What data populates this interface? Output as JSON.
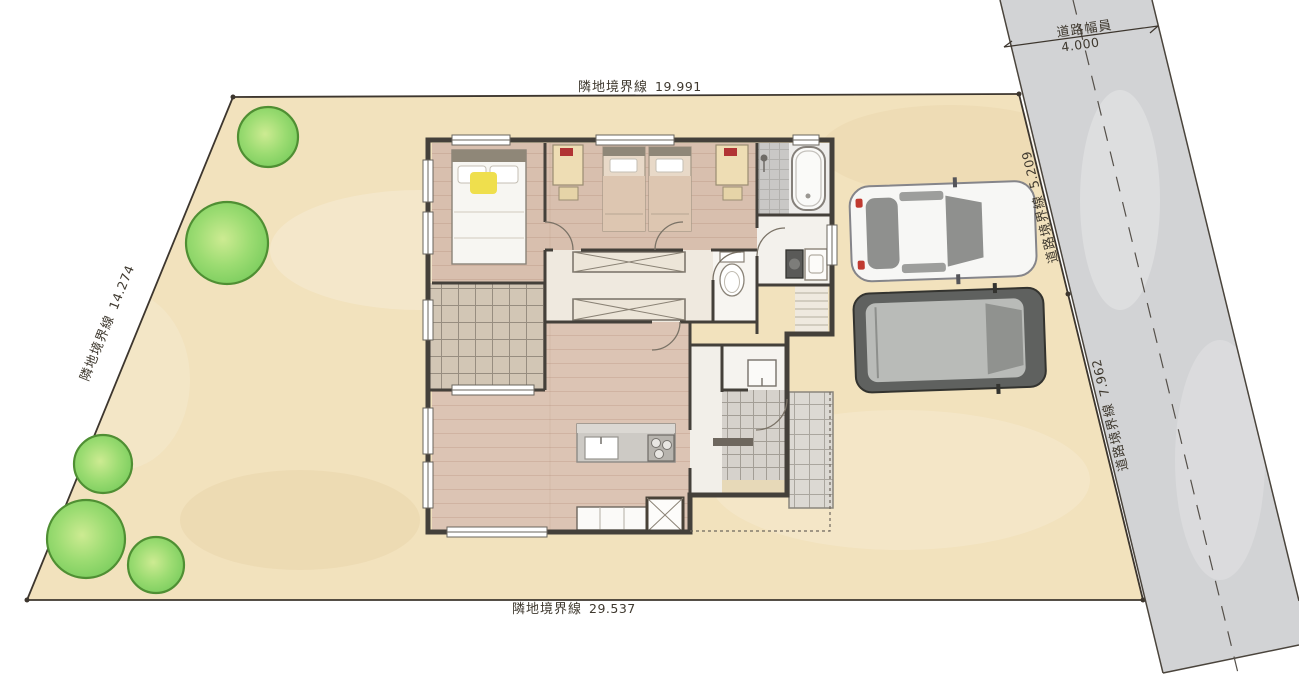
{
  "plan": {
    "type": "site-and-floor-plan",
    "boundaries": {
      "top": {
        "label": "隣地境界線",
        "value": "19.991"
      },
      "left": {
        "label": "隣地境界線",
        "value": "14.274"
      },
      "bottom": {
        "label": "隣地境界線",
        "value": "29.537"
      },
      "road_upper": {
        "label": "道路境界線",
        "value": "5.209"
      },
      "road_lower": {
        "label": "道路境界線",
        "value": "7.962"
      },
      "road_width": {
        "label": "道路幅員",
        "value": "4.000"
      }
    },
    "colors": {
      "lot": "#f2e2bd",
      "road": "#d2d3d5",
      "wall": "#44403a",
      "wood_floor": "#d8bfae",
      "deck": "#d2c6b5",
      "tile": "#d6d2cc",
      "tree": "#82d264",
      "tree_light": "#c9ec90",
      "accent_yellow": "#efdf4d",
      "car_white": "#f7f7f5",
      "car_gray": "#5f615f"
    },
    "objects": {
      "trees_count": 5,
      "cars": [
        "white-sedan",
        "dark-gray-suv"
      ],
      "rooms": [
        "master-bedroom",
        "kids-bedroom",
        "bathroom",
        "washroom",
        "toilet",
        "corridor",
        "ldk",
        "kitchen",
        "deck-terrace",
        "entrance-genkan",
        "porch"
      ]
    }
  }
}
